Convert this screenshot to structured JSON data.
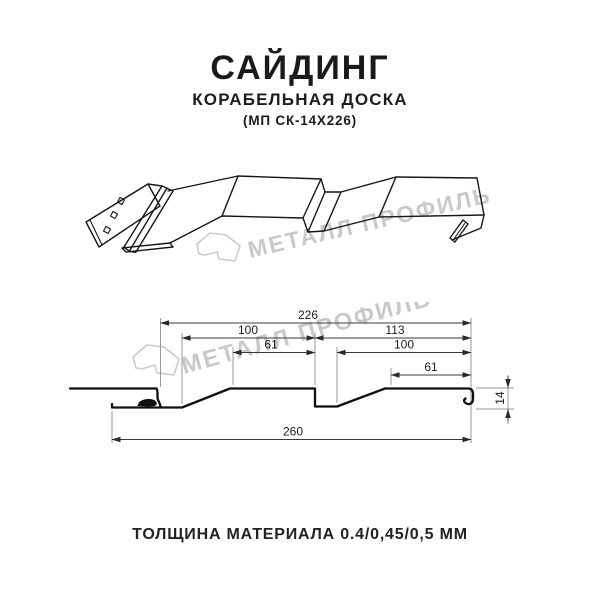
{
  "header": {
    "title": "САЙДИНГ",
    "subtitle": "КОРАБЕЛЬНАЯ ДОСКА",
    "model": "(МП СК-14Х226)"
  },
  "watermark": {
    "text": "МЕТАЛЛ ПРОФИЛЬ",
    "color": "#c9c9c9"
  },
  "section": {
    "units": "mm",
    "dims": {
      "overall_top": "226",
      "upper_left": "100",
      "upper_right": "113",
      "mid_left": "61",
      "mid_right": "100",
      "lower_right": "61",
      "overall_bottom": "260",
      "height": "14"
    }
  },
  "footer": {
    "text": "ТОЛЩИНА МАТЕРИАЛА 0.4/0,45/0,5 ММ"
  },
  "colors": {
    "background": "#ffffff",
    "line": "#161616",
    "dimension_line": "#3a3a3a",
    "extension_line": "#9a9a9a",
    "watermark": "#c9c9c9",
    "text": "#1a1a1a"
  }
}
